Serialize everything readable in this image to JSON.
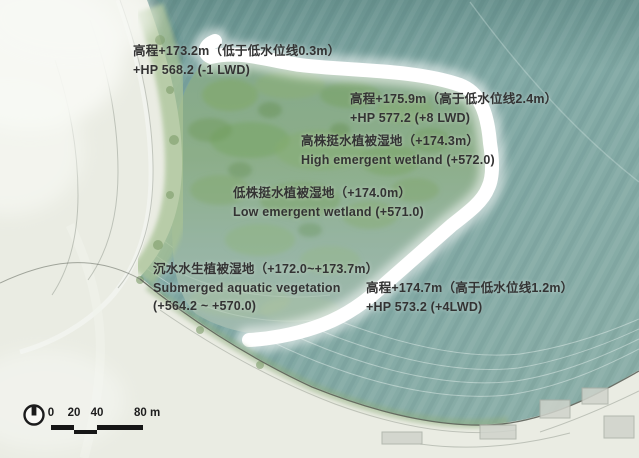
{
  "map": {
    "name": "wetland-restoration-site-plan",
    "colors": {
      "water": "#7fa7a3",
      "water_dark": "#6d9b97",
      "water_light": "#a3bfb6",
      "island_green": "#84aa6d",
      "lagoon": "#9cb8ae",
      "breakwater": "#ffffff",
      "land": "#eaece3",
      "shore_trees": "#a8c295",
      "text": "#333333",
      "scalebar": "#161616"
    }
  },
  "annotations": [
    {
      "lines": [
        "高程+173.2m（低于低水位线0.3m）",
        "+HP 568.2 (-1 LWD)"
      ]
    },
    {
      "lines": [
        "高程+175.9m（高于低水位线2.4m）",
        "+HP 577.2 (+8 LWD)"
      ]
    },
    {
      "lines": [
        "高株挺水植被湿地（+174.3m）",
        "High emergent wetland (+572.0)"
      ]
    },
    {
      "lines": [
        "低株挺水植被湿地（+174.0m）",
        "Low emergent wetland (+571.0)"
      ]
    },
    {
      "lines": [
        "沉水水生植被湿地（+172.0~+173.7m）",
        "Submerged aquatic vegetation",
        "(+564.2 ~ +570.0)"
      ]
    },
    {
      "lines": [
        "高程+174.7m（高于低水位线1.2m）",
        "+HP 573.2 (+4LWD)"
      ]
    }
  ],
  "scale_bar": {
    "tick_labels": [
      "0",
      "20",
      "40",
      "80 m"
    ]
  }
}
